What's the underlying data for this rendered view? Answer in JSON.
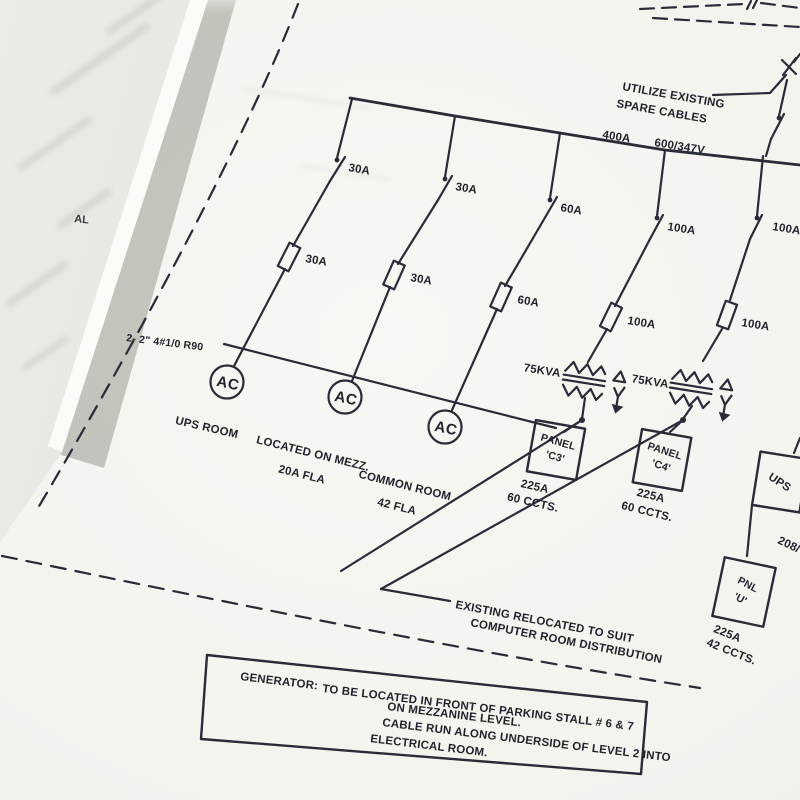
{
  "photo": {
    "page_edge_fragment": "AL"
  },
  "diagram": {
    "ink_color": "#2a2a38",
    "supply_note": {
      "line1": "UTILIZE EXISTING",
      "line2": "SPARE CABLES"
    },
    "bus": {
      "rating": "400A",
      "voltage": "600/347V"
    },
    "feeders": [
      {
        "switch_rating": "30A",
        "fuse_rating": "30A"
      },
      {
        "switch_rating": "30A",
        "fuse_rating": "30A"
      },
      {
        "switch_rating": "60A",
        "fuse_rating": "60A"
      },
      {
        "switch_rating": "100A",
        "fuse_rating": "100A"
      },
      {
        "switch_rating": "100A",
        "fuse_rating": "100A"
      }
    ],
    "ac_units": [
      {
        "symbol": "AC",
        "label_line1": "UPS ROOM",
        "label_line2": ""
      },
      {
        "symbol": "AC",
        "label_line1": "LOCATED ON MEZZ.",
        "label_line2": "20A FLA"
      },
      {
        "symbol": "AC",
        "label_line1": "COMMON ROOM",
        "label_line2": "42 FLA"
      }
    ],
    "cable_tag": "2- 2\" 4#1/0 R90",
    "transformers": [
      {
        "rating": "75KVA"
      },
      {
        "rating": "75KVA"
      }
    ],
    "panels": [
      {
        "line1": "PANEL",
        "line2": "'C3'",
        "rating": "225A",
        "circuits": "60 CCTS."
      },
      {
        "line1": "PANEL",
        "line2": "'C4'",
        "rating": "225A",
        "circuits": "60 CCTS."
      },
      {
        "line1": "PNL",
        "line2": "'U'",
        "rating": "225A",
        "circuits": "42 CCTS."
      }
    ],
    "ups": {
      "label": "UPS",
      "voltage_tag": "208/"
    },
    "relocation_note": {
      "line1": "EXISTING RELOCATED TO SUIT",
      "line2": "COMPUTER ROOM DISTRIBUTION"
    },
    "generator_note": {
      "label": "GENERATOR:",
      "line1": "TO BE LOCATED IN FRONT OF PARKING STALL # 6 & 7",
      "line2": "ON MEZZANINE LEVEL.",
      "line3": "CABLE RUN ALONG UNDERSIDE OF LEVEL 2 INTO",
      "line4": "ELECTRICAL ROOM."
    }
  }
}
